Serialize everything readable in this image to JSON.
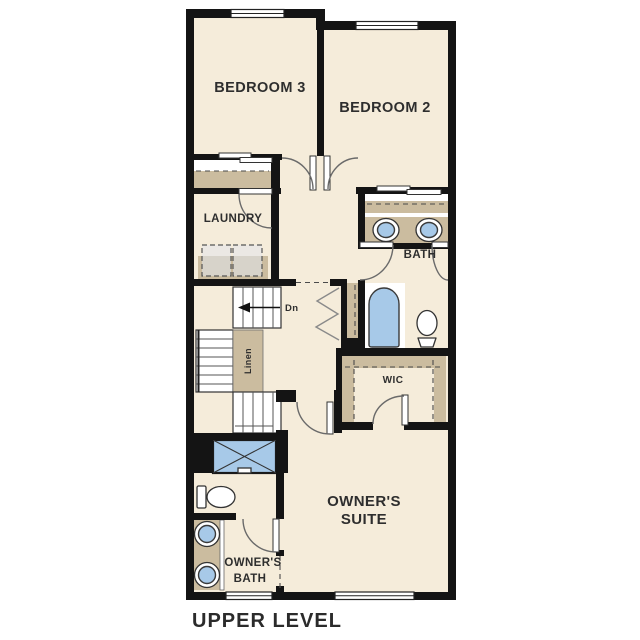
{
  "plan": {
    "caption": "UPPER LEVEL",
    "rooms": {
      "bedroom3": "BEDROOM 3",
      "bedroom2": "BEDROOM 2",
      "laundry": "LAUNDRY",
      "bath": "BATH",
      "wic": "WIC",
      "owners_suite_line1": "OWNER'S",
      "owners_suite_line2": "SUITE",
      "owners_bath_line1": "OWNER'S",
      "owners_bath_line2": "BATH",
      "linen_closet": "Linen",
      "stairs_direction": "Dn"
    },
    "colors": {
      "floor": "#f5ecda",
      "wall": "#141414",
      "casework_tan": "#cbbc9f",
      "fixture_blue": "#a7c9e8",
      "label_text": "#2e2e2e"
    }
  }
}
